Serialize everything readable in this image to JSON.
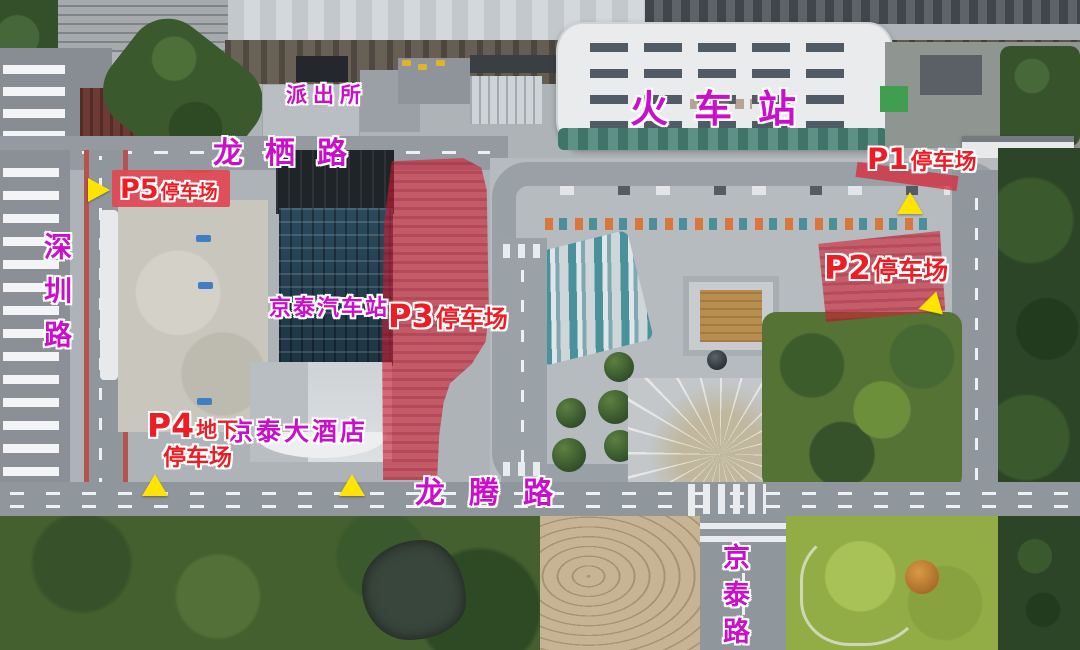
{
  "places": {
    "train_station": "火车站",
    "police_station": "派出所",
    "jingtai_bus_station": "京泰汽车站",
    "jingtai_hotel": "京泰大酒店"
  },
  "roads": {
    "longxi": "龙栖路",
    "shenzhen": "深圳路",
    "longteng": "龙腾路",
    "jingtai": "京泰路"
  },
  "parking": {
    "p1": {
      "code": "P1",
      "label": "停车场"
    },
    "p2": {
      "code": "P2",
      "label": "停车场"
    },
    "p3": {
      "code": "P3",
      "label": "停车场"
    },
    "p4": {
      "code": "P4",
      "mid": "地下",
      "label": "停车场"
    },
    "p5": {
      "code": "P5",
      "label": "停车场"
    }
  },
  "colors": {
    "road_label_magenta": "#cb0ecb",
    "parking_label_red": "#ee1c25",
    "highlight_zone_red": "#d6233c",
    "arrow_yellow": "#ffe400"
  }
}
